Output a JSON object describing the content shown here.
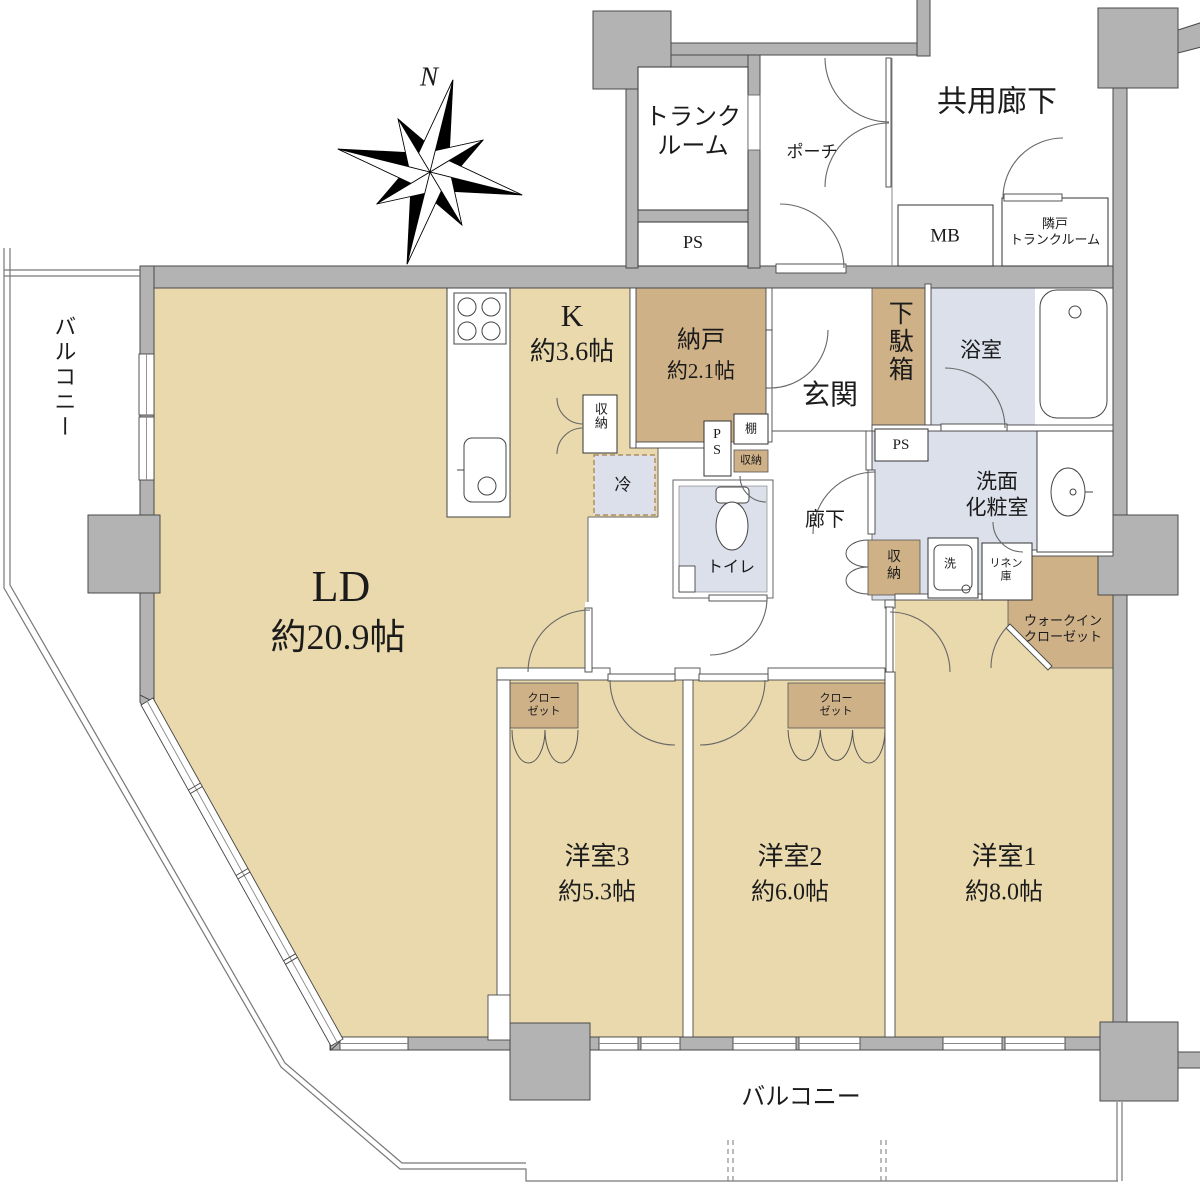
{
  "colors": {
    "floor_tan": "#e9d9ad",
    "storage_brown": "#cfb188",
    "wet_blue": "#dce0eb",
    "wall_gray": "#b3b3b3",
    "line_dark": "#4a4a4a"
  },
  "compass": {
    "north_label": "N"
  },
  "common_areas": {
    "trunk_room": {
      "line1": "トランク",
      "line2": "ルーム"
    },
    "pipe_space_top": "PS",
    "porch": "ポーチ",
    "common_corridor": "共用廊下",
    "meter_box": "MB",
    "neighbor_trunk_room": {
      "line1": "隣戸",
      "line2": "トランクルーム"
    }
  },
  "rooms": {
    "living_dining": {
      "name": "LD",
      "size": "約20.9帖"
    },
    "kitchen": {
      "name": "K",
      "size": "約3.6帖"
    },
    "storage_room": {
      "name": "納戸",
      "size": "約2.1帖"
    },
    "bedroom1": {
      "name": "洋室1",
      "size": "約8.0帖"
    },
    "bedroom2": {
      "name": "洋室2",
      "size": "約6.0帖"
    },
    "bedroom3": {
      "name": "洋室3",
      "size": "約5.3帖"
    },
    "entrance": "玄関",
    "hallway": "廊下",
    "toilet": "トイレ",
    "bathroom": "浴室",
    "washroom": {
      "line1": "洗面",
      "line2": "化粧室"
    },
    "walk_in_closet": {
      "line1": "ウォークイン",
      "line2": "クローゼット"
    }
  },
  "fixtures": {
    "shoe_cabinet": "下駄箱",
    "pipe_space_mid": "PS",
    "pipe_space_right": "PS",
    "shelf": "棚",
    "storage_mid": "収納",
    "storage_kitchen": "収納",
    "storage_hall": {
      "line1": "収",
      "line2": "納"
    },
    "refrigerator": "冷",
    "washer": "洗",
    "linen_cabinet": {
      "line1": "リネン",
      "line2": "庫"
    },
    "closet_bedroom2": {
      "line1": "クロー",
      "line2": "ゼット"
    },
    "closet_bedroom3": {
      "line1": "クロー",
      "line2": "ゼット"
    }
  },
  "exterior": {
    "balcony_left": "バルコニー",
    "balcony_bottom": "バルコニー"
  }
}
